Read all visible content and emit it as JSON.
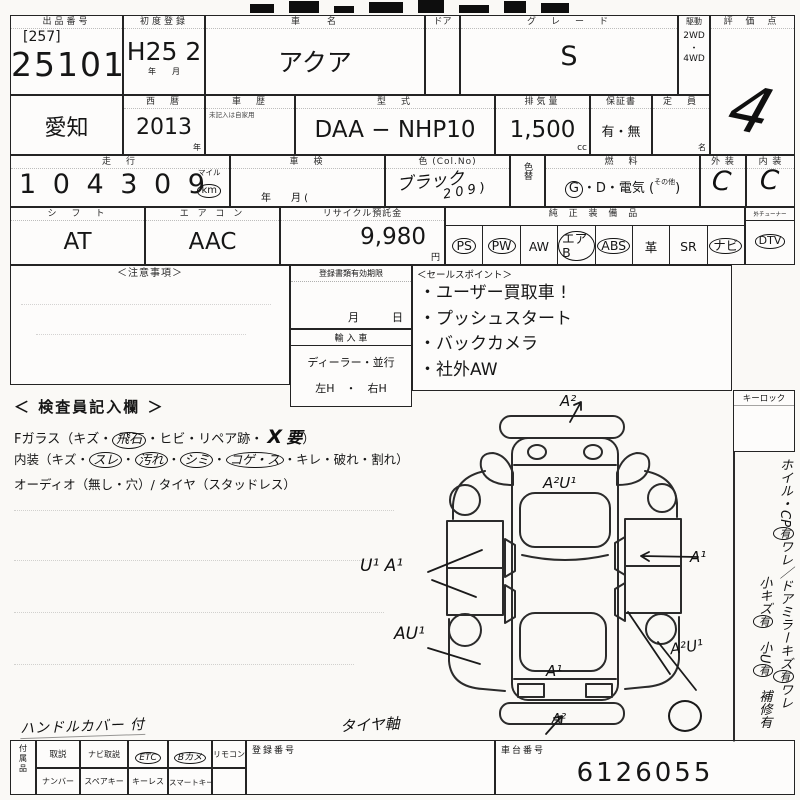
{
  "row1": {
    "lot_label": "出品番号",
    "lot_bracket": "[257]",
    "lot_number": "25101",
    "firstreg_label": "初度登録",
    "firstreg": "H25 2",
    "firstreg_unit": "年　　月",
    "name_label": "車　　名",
    "name": "アクア",
    "door_label": "ドア",
    "grade_label": "グ　レ　ー　ド",
    "grade": "S",
    "drive_label": "駆動",
    "drive_a": "2WD",
    "drive_dot": "・",
    "drive_b": "4WD",
    "score_label": "評 価 点",
    "score": "4"
  },
  "row2": {
    "pref": "愛知",
    "year_label": "西　暦",
    "year": "2013",
    "year_unit": "年",
    "hist_label": "車　歴",
    "hist_note": "未記入は自家用",
    "model_label": "型　式",
    "model": "DAA −  NHP10",
    "disp_label": "排気量",
    "disp": "1,500",
    "disp_unit": "cc",
    "warr_label": "保証書",
    "warr": "有・無",
    "cap_label": "定　員",
    "cap_unit": "名"
  },
  "row3": {
    "run_label": "走　行",
    "run": "1 0 4  3 0 9",
    "mile": "マイル",
    "km": "km",
    "shaken_label": "車　検",
    "shaken_unit": "年　　月 (",
    "color_label": "色 (Col.No)",
    "color": "ブラック",
    "color_no": "2 0 9 )",
    "colorchg_label": "色替",
    "fuel_label": "燃　料",
    "fuel_g": "G",
    "fuel_mid": "・D・電気 (",
    "fuel_other": "その他",
    "fuel_end": ")",
    "ext_label": "外 装",
    "ext": "C",
    "int_label": "内 装",
    "int": "C"
  },
  "row4": {
    "shift_label": "シ　フ　ト",
    "shift": "AT",
    "ac_label": "エ ア コ ン",
    "ac": "AAC",
    "rec_label": "リサイクル預託金",
    "rec": "9,980",
    "rec_unit": "円",
    "equip_label": "純 正 装 備 品",
    "equip": [
      {
        "label": "PS",
        "circled": true
      },
      {
        "label": "PW",
        "circled": true
      },
      {
        "label": "AW",
        "circled": false
      },
      {
        "label": "エアB",
        "circled": true
      },
      {
        "label": "ABS",
        "circled": true
      },
      {
        "label": "革",
        "circled": false
      },
      {
        "label": "SR",
        "circled": false
      },
      {
        "label": "ナビ",
        "circled": true
      }
    ],
    "tuner_label": "外チューナー",
    "dtv": {
      "label": "DTV",
      "circled": true
    }
  },
  "notice_label": "＜注意事項＞",
  "docs": {
    "label": "登録書類有効期限",
    "unit": "月　　　日",
    "imp_label": "輸 入 車",
    "imp_opts": "ディーラー・並行",
    "imp_handle": "左H　・　右H"
  },
  "sales": {
    "label": "＜セールスポイント＞",
    "points": [
      "・ユーザー買取車 !",
      "・プッシュスタート",
      "・バックカメラ",
      "・社外AW"
    ]
  },
  "inspector": {
    "heading": "＜ 検査員記入欄 ＞",
    "g1": "Fガラス（キズ・",
    "g2": "飛石",
    "g3": "・ヒビ・リペア跡・",
    "gx": "X",
    "g4": "要",
    "g5": "）",
    "i1": "内装（キズ・",
    "i2": "スレ",
    "i3": "・",
    "i4": "汚れ",
    "i5": "・",
    "i6": "シミ",
    "i7": "・",
    "i8": "コゲ・ス",
    "i9": "・キレ・破れ・割れ）",
    "audio": "オーディオ（無し・穴）/ タイヤ（スタッドレス）"
  },
  "keylock_label": "キーロック",
  "vmargin": {
    "s1": "ホイル・CP",
    "s2": "有",
    "s3": "ワレ／ドアミラーキズ",
    "s4": "有",
    "s5": "ワレ",
    "s6": "小キズ",
    "s7": "有",
    "s8": "　小U",
    "s9": "有",
    "s10": "　補修有"
  },
  "marks": {
    "front": "A²",
    "hood": "A²U¹",
    "left": "U¹ A¹",
    "left_rear": "AU¹",
    "right": "A¹",
    "right_rear": "A²U¹",
    "rear": "A¹",
    "bottom": "A²"
  },
  "notes": {
    "handle": "ハンドルカバー 付",
    "tire": "タイヤ軸"
  },
  "bottom": {
    "acc_label": "付属品",
    "top": [
      {
        "label": "取説",
        "circled": false
      },
      {
        "label": "ナビ取説",
        "circled": false
      },
      {
        "label": "ETC",
        "circled": true
      },
      {
        "label": "Bカメ",
        "circled": true
      },
      {
        "label": "リモコン",
        "circled": false
      }
    ],
    "bot": [
      "ナンバー",
      "スペアキー",
      "キーレス",
      "スマートキー"
    ],
    "reg_label": "登録番号",
    "chassis_label": "車台番号",
    "chassis": "6126055"
  }
}
